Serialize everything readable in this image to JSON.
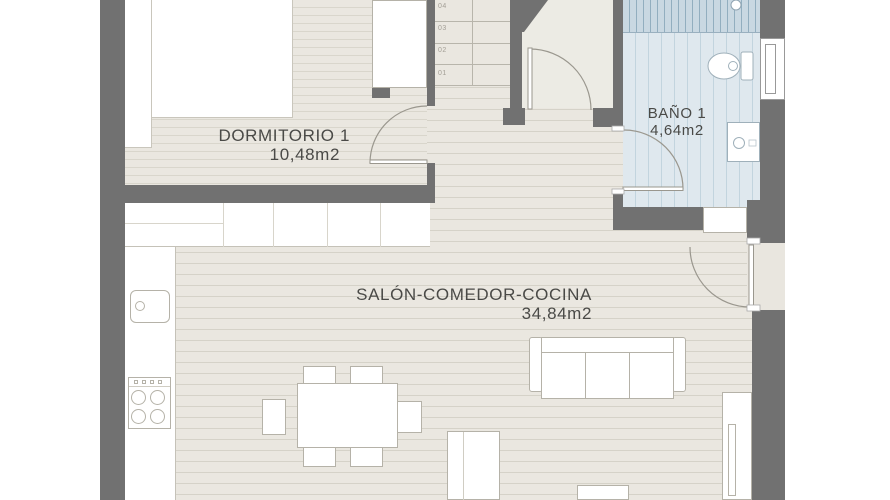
{
  "plan": {
    "rooms": {
      "bedroom": {
        "label": "DORMITORIO 1",
        "area": "10,48m2"
      },
      "bathroom": {
        "label": "BAÑO 1",
        "area": "4,64m2"
      },
      "living": {
        "label": "SALÓN-COMEDOR-COCINA",
        "area": "34,84m2"
      }
    },
    "stairs": {
      "treads": [
        "04",
        "03",
        "02",
        "01"
      ]
    },
    "colors": {
      "wall": "#717171",
      "floor": "#eae7e0",
      "floor_line": "#d5d2c8",
      "bath_floor": "#dfe8ee",
      "bath_stripe": "#c2d4de",
      "shower": "#c9d8e2",
      "shower_stripe": "#92aebf",
      "hall_floor": "#ecebe4",
      "label_text": "#4a4a47"
    }
  }
}
